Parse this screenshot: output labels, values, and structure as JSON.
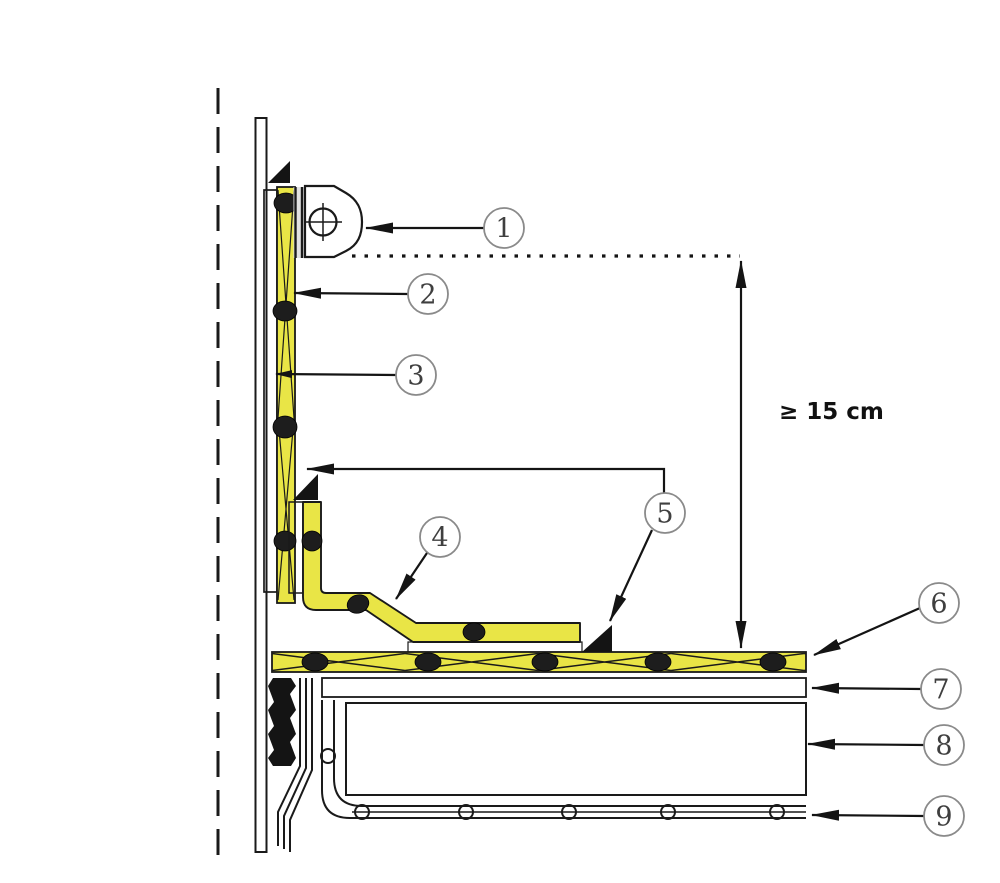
{
  "drawing": {
    "dimension_label": "≥ 15 cm",
    "callouts": [
      {
        "label": "1"
      },
      {
        "label": "2"
      },
      {
        "label": "3"
      },
      {
        "label": "4"
      },
      {
        "label": "5"
      },
      {
        "label": "6"
      },
      {
        "label": "7"
      },
      {
        "label": "8"
      },
      {
        "label": "9"
      }
    ],
    "colors": {
      "membrane_yellow": "#e9e546",
      "line": "#1a1a1a",
      "callout_stroke": "#8a8a8a",
      "callout_number": "#3f3f3f"
    }
  }
}
